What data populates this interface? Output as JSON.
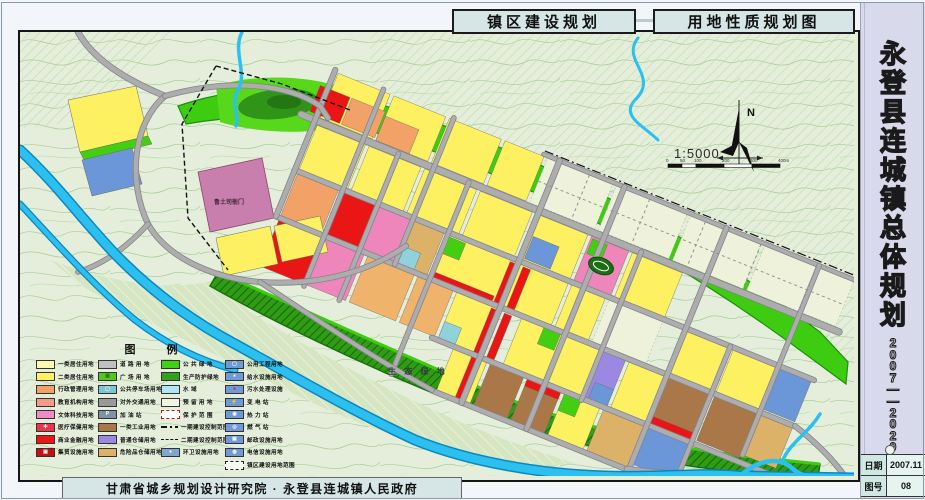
{
  "titles": {
    "left": "镇区建设规划",
    "right": "用地性质规划图"
  },
  "sidebar": {
    "title": "永登县连城镇总体规划",
    "title_chars": [
      "永",
      "登",
      "县",
      "连",
      "城",
      "镇",
      "总",
      "体",
      "规",
      "划"
    ],
    "period": "2007——2020",
    "period_chars": [
      "2",
      "0",
      "0",
      "7",
      "—",
      "—",
      "2",
      "0",
      "2",
      "0"
    ],
    "date_label": "日期",
    "date_value": "2007.11",
    "sheet_label": "图号",
    "sheet_value": "08"
  },
  "footer": {
    "credit": "甘肃省城乡规划设计研究院 · 永登县连城镇人民政府"
  },
  "compass": {
    "north": "N",
    "scale": "1:5000",
    "bar_labels": [
      "0",
      "50",
      "100",
      "200",
      "300",
      "400m"
    ]
  },
  "map_labels": {
    "eco_green": "生 态 绿 地",
    "yamen": "鲁土司衙门"
  },
  "legend": {
    "title": "图  例",
    "columns": [
      {
        "items": [
          {
            "label": "一类居住用地",
            "swatch": "#fff9b0",
            "type": "fill"
          },
          {
            "label": "二类居住用地",
            "swatch": "#fdf162",
            "type": "fill"
          },
          {
            "label": "行政管理用地",
            "swatch": "#f2a267",
            "type": "fill"
          },
          {
            "label": "教育机构用地",
            "swatch": "#f49b8a",
            "type": "fill"
          },
          {
            "label": "文体科技用地",
            "swatch": "#ef8cc4",
            "type": "fill"
          },
          {
            "label": "医疗保健用地",
            "swatch": "#ea3448",
            "type": "fill",
            "glyph": "✚",
            "glyph_color": "#ffffff"
          },
          {
            "label": "商业金融用地",
            "swatch": "#ea1515",
            "type": "fill"
          },
          {
            "label": "集贸设施用地",
            "swatch": "#c80f0f",
            "type": "fill",
            "glyph": "▣",
            "glyph_color": "#ffffff"
          }
        ]
      },
      {
        "items": [
          {
            "label": "道 路 用 地",
            "swatch": "#c0c0c0",
            "type": "fill"
          },
          {
            "label": "广 场 用 地",
            "swatch": "#52c81e",
            "type": "fill",
            "glyph": "▦",
            "glyph_color": "#2a7a10"
          },
          {
            "label": "公共停车场用地",
            "swatch": "#79c6d4",
            "type": "fill",
            "glyph": "▢",
            "glyph_color": "#ffffff"
          },
          {
            "label": "对外交通用地",
            "swatch": "#9a9a9a",
            "type": "fill"
          },
          {
            "label": "加  油  站",
            "swatch": "#7e93a5",
            "type": "fill",
            "glyph": "P",
            "glyph_color": "#ffffff"
          },
          {
            "label": "一类工业用地",
            "swatch": "#aa7748",
            "type": "fill"
          },
          {
            "label": "普通仓储用地",
            "swatch": "#9a88e2",
            "type": "fill"
          },
          {
            "label": "危险品仓储用地",
            "swatch": "#dcb168",
            "type": "fill"
          }
        ]
      },
      {
        "items": [
          {
            "label": "公 共 绿 地",
            "swatch": "#3ed312",
            "type": "fill"
          },
          {
            "label": "生产防护绿地",
            "swatch": "#2fa31a",
            "type": "fill"
          },
          {
            "label": "水       域",
            "swatch": "#aee8f8",
            "type": "fill"
          },
          {
            "label": "预 留 用 地",
            "swatch": "#f2f2e2",
            "type": "fill"
          },
          {
            "label": "保 护 范 围",
            "swatch": "#ffffff",
            "type": "box-dash-red"
          },
          {
            "label": "一期建设控制范围",
            "swatch": "#111111",
            "type": "line-dashdot"
          },
          {
            "label": "二期建设控制范围",
            "swatch": "#111111",
            "type": "line-dash"
          },
          {
            "label": "环卫设施用地",
            "swatch": "#7fa8d0",
            "type": "fill",
            "glyph": "●",
            "glyph_color": "#ffffff"
          }
        ]
      },
      {
        "items": [
          {
            "label": "公用工程用地",
            "swatch": "#6f9ad8",
            "type": "fill",
            "glyph": "▢",
            "glyph_color": "#ffffff"
          },
          {
            "label": "给水设施用地",
            "swatch": "#6f9ad8",
            "type": "fill",
            "glyph": "●",
            "glyph_color": "#ffffff"
          },
          {
            "label": "污水处理设施",
            "swatch": "#6f9ad8",
            "type": "fill",
            "glyph": "●",
            "glyph_color": "#e02020"
          },
          {
            "label": "变  电  站",
            "swatch": "#6f9ad8",
            "type": "fill",
            "glyph": "⚡",
            "glyph_color": "#ffe020"
          },
          {
            "label": "热  力  站",
            "swatch": "#6f9ad8",
            "type": "fill",
            "glyph": "◉",
            "glyph_color": "#ffffff"
          },
          {
            "label": "燃  气  站",
            "swatch": "#6f9ad8",
            "type": "fill",
            "glyph": "◎",
            "glyph_color": "#ffffff"
          },
          {
            "label": "邮政设施用地",
            "swatch": "#6f9ad8",
            "type": "fill",
            "glyph": "▣",
            "glyph_color": "#ffffff"
          },
          {
            "label": "电信设施用地",
            "swatch": "#6f9ad8",
            "type": "fill",
            "glyph": "◍",
            "glyph_color": "#ffffff"
          },
          {
            "label": "镇区建设用地范围",
            "swatch": "#f6f8f2",
            "type": "box-dash-black"
          }
        ]
      }
    ]
  },
  "colors": {
    "map_bg": "#e4eeda",
    "contour": "#a6cc96",
    "river": "#2cc0f0",
    "river_edge": "#0a86c0",
    "green_belt": "#3ecc10",
    "protect_belt": "#2f9c14",
    "eco_fill": "#d6e6c2",
    "road": "#adadad",
    "road_edge": "#83838d",
    "residential": "#fdf162",
    "residential1": "#fff9b0",
    "admin": "#f2a267",
    "edu": "#efb36b",
    "culture": "#ee85bb",
    "historic": "#c87fae",
    "commercial": "#ea1515",
    "industry": "#aa7748",
    "warehouse": "#9a88e2",
    "utility": "#6b96d8",
    "cyan": "#8fd2dc",
    "khaki": "#dcb168",
    "reserve": "#eef2da",
    "park_dark": "#2f9418",
    "sidebar_bg": "#d9d9ec",
    "tab_bg": "#d6e6e6"
  }
}
